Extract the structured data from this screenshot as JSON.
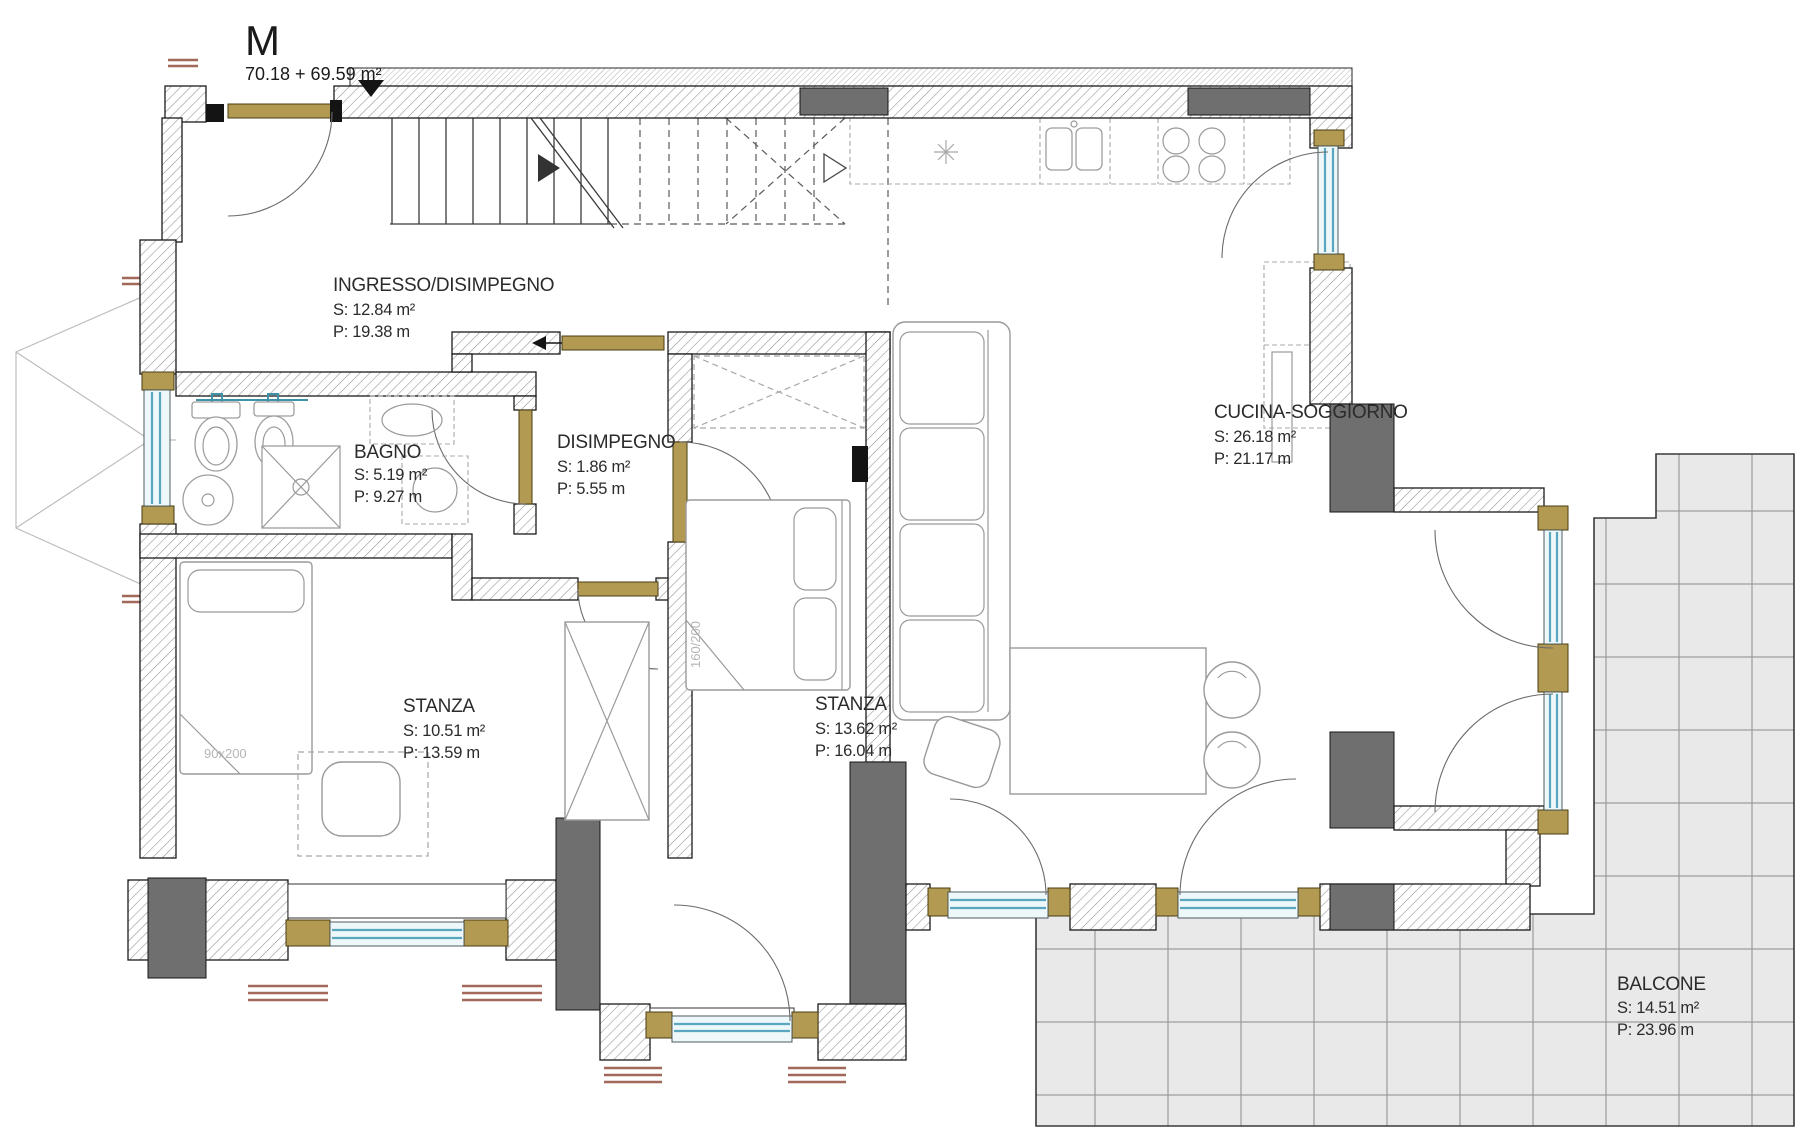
{
  "plan": {
    "title": "M",
    "total_area": "70.18 + 69.59 m²"
  },
  "rooms": [
    {
      "name": "INGRESSO/DISIMPEGNO",
      "surface": "S: 12.84 m²",
      "perimeter": "P: 19.38 m"
    },
    {
      "name": "BAGNO",
      "surface": "S: 5.19 m²",
      "perimeter": "P: 9.27 m"
    },
    {
      "name": "DISIMPEGNO",
      "surface": "S: 1.86 m²",
      "perimeter": "P: 5.55 m"
    },
    {
      "name": "CUCINA-SOGGIORNO",
      "surface": "S: 26.18 m²",
      "perimeter": "P: 21.17 m"
    },
    {
      "name": "STANZA",
      "surface": "S: 10.51 m²",
      "perimeter": "P: 13.59 m"
    },
    {
      "name": "STANZA",
      "surface": "S: 13.62 m²",
      "perimeter": "P: 16.04 m"
    },
    {
      "name": "BALCONE",
      "surface": "S: 14.51 m²",
      "perimeter": "P: 23.96 m"
    }
  ],
  "furniture_labels": {
    "single_bed_size": "90x200",
    "double_bed_size": "160/200"
  },
  "colors": {
    "wall_outline": "#1a1a1a",
    "hatch_line": "#909090",
    "pier_fill": "#6f6f6f",
    "door_wood": "#b39a52",
    "window_glass_line": "#58a7bf",
    "window_glass_fill": "#eef8fb",
    "balcony_tile_fill": "#e9e9e9",
    "balcony_tile_line": "#9a9a9a",
    "radiator_sill": "#a2685a",
    "sanitary_teal": "#3e93a8",
    "label_text": "#2b2b2b",
    "faint_text": "#b5b5b5"
  }
}
